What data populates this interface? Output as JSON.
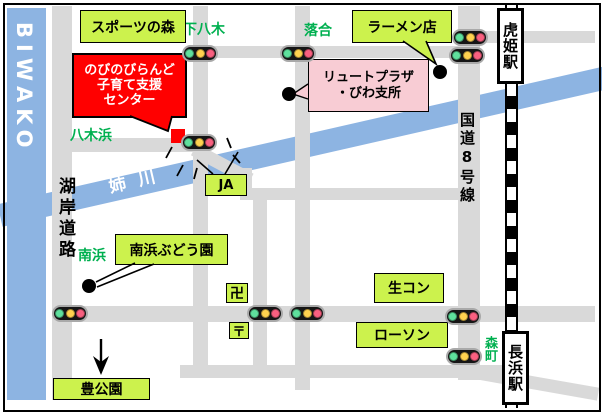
{
  "colors": {
    "road": "#D9D9D9",
    "water": "#8DB4E2",
    "accent": "#CCF24D",
    "greentext": "#00B050",
    "red": "#FF0000",
    "pink": "#F8CCD4"
  },
  "lake": {
    "label": "BIWAKO"
  },
  "river": {
    "label": "姉川"
  },
  "roads": {
    "kogan_label": "湖岸道路",
    "route8_label": "国道8号線"
  },
  "stations": {
    "torahime": "虎姫駅",
    "nagahama": "長浜駅"
  },
  "areas": {
    "shimoyagi": "下八木",
    "ochiai": "落合",
    "yagihama": "八木浜",
    "minamihama": "南浜",
    "morimachi": "森町"
  },
  "pois": {
    "sports_forest": "スポーツの森",
    "ramen": "ラーメン店",
    "ja": "JA",
    "grape_farm": "南浜ぶどう園",
    "namakon": "生コン",
    "lawson": "ローソン",
    "toyo_park": "豊公園",
    "temple_mark": "卍",
    "post_mark": "〒"
  },
  "destination": {
    "line1": "のびのびらんど",
    "line2": "子育て支援",
    "line3": "センター"
  },
  "office": {
    "line1": "リュートプラザ",
    "line2": "・びわ支所"
  }
}
